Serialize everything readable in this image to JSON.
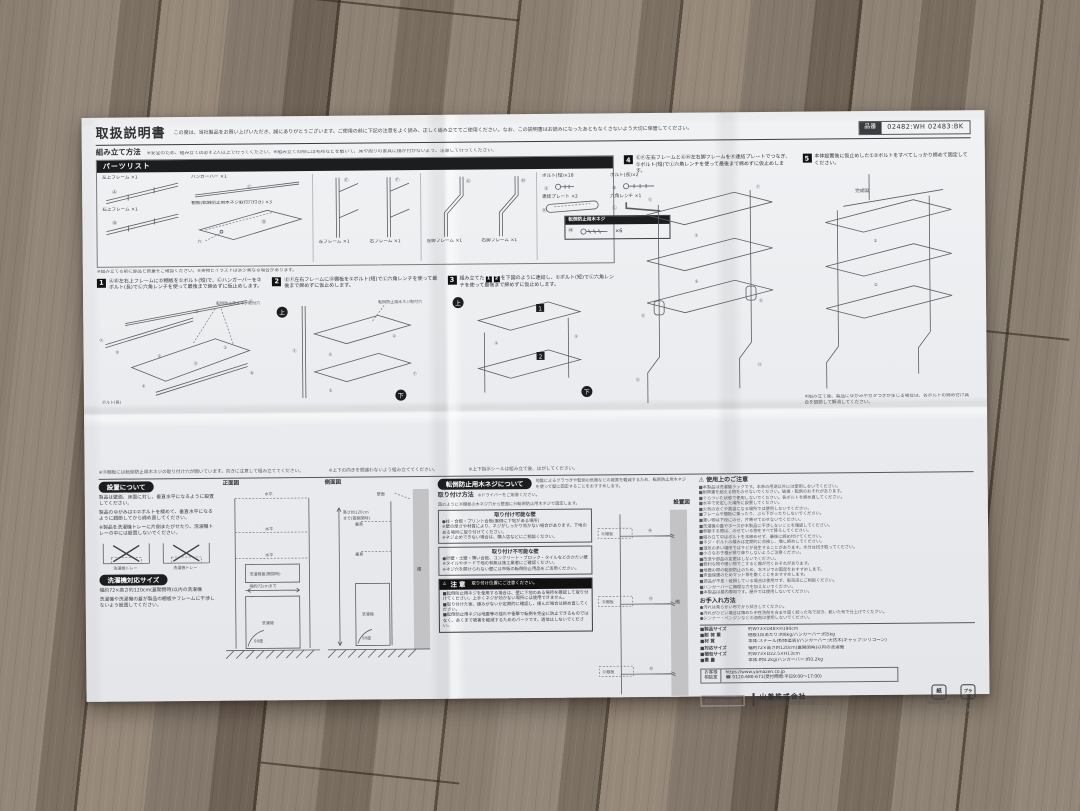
{
  "doc": {
    "title": "取扱説明書",
    "intro": "この度は、当社製品をお買い上げいただき、誠にありがとうございます。ご使用の前に下記の注意をよく読み、正しく組み立ててご使用ください。なお、この説明書はお読みになったあともなくさないよう大切に保管してください。",
    "part_no_label": "品番",
    "part_no": "02482:WH 02483:BK"
  },
  "assembly": {
    "heading": "組み立て方法",
    "note": "※安全のため、組み立ては必ず2人以上で行ってください。※組み立ての際には毛布などを敷いて、床や周りの家具に傷が付かないよう、注意して行ってください。"
  },
  "parts": {
    "heading": "パーツリスト",
    "items": [
      {
        "tag": "Ⓐ",
        "label": "左上フレーム ×1"
      },
      {
        "tag": "Ⓒ",
        "label": "ハンガーバー ×1"
      },
      {
        "tag": "Ⓑ",
        "label": "右上フレーム ×1"
      },
      {
        "tag": "Ⓓ",
        "label": "棚板(転倒防止用木ネジ取付穴付き) ×3"
      },
      {
        "tag": "Ⓔ",
        "label": "左フレーム ×1"
      },
      {
        "tag": "Ⓕ",
        "label": "右フレーム ×1"
      },
      {
        "tag": "Ⓖ",
        "label": "左脚フレーム ×1"
      },
      {
        "tag": "Ⓗ",
        "label": "右脚フレーム ×1"
      },
      {
        "tag": "①",
        "label": "ボルト(短)×18"
      },
      {
        "tag": "②",
        "label": "ボルト(長)×2"
      },
      {
        "tag": "Ⓚ",
        "label": "連結プレート ×2"
      },
      {
        "tag": "Ⓛ",
        "label": "六角レンチ ×1"
      }
    ],
    "wood_screw": {
      "heading": "転倒防止用木ネジ",
      "tag": "Ⓜ",
      "count": "×6"
    },
    "hole_label": "穴",
    "note": "※組み立てる前に部品と数量をご確認ください。※実物とイラストは多少異なる場合があります。"
  },
  "glyphs": {
    "up": "上",
    "down": "下",
    "b1": "①",
    "b2": "②"
  },
  "steps": {
    "s1": {
      "no": "1",
      "text": "ⒶⒷ左右上フレームにⒹ棚板を①ボルト(短)で、Ⓒハンガーバーを②ボルト(長)でⓁ六角レンチを使って最後まで締めずに仮止めします。"
    },
    "s2": {
      "no": "2",
      "text": "ⒺⒻ左右フレームにⒹ棚板を①ボルト(短)でⓁ六角レンチを使って最後まで締めずに仮止めします。"
    },
    "s3": {
      "no": "3",
      "pre": "組み立てた",
      "b1": "1",
      "b2": "2",
      "post": "を下図のように連結し、①ボルト(短)でⓁ六角レンチを使って最後まで締めずに仮止めします。"
    },
    "s4": {
      "no": "4",
      "text": "ⒺⒻ左右フレームとⒼⒽ左右脚フレームをⓀ連結プレートでつなぎ、①ボルト(短)でⓁ六角レンチを使って最後まで締めずに仮止めします。"
    },
    "s5": {
      "no": "5",
      "text": "本体設置後に仮止めした①②ボルトをすべてしっかり締めて固定してください。"
    },
    "labels": {
      "hole": "転倒防止用木ネジ取付穴",
      "bolt_long": "ボルト(長)",
      "complete": "完成図"
    },
    "notes": {
      "shelf": "※Ⓓ棚板には転倒防止用木ネジの取り付け穴が開いています。向きに注意して組み立ててください。",
      "updown": "※上下の向きを間違わないよう組み立ててください。",
      "seal": "※上下指示シールは組み立て後、はがしてください。",
      "wobble": "※組み立て後、製品にゆがみやガタつきが生じる場合は、各ボルトの締め付け具合を調節して解消してください。"
    }
  },
  "setup": {
    "heading": "設置について",
    "p1": "製品は壁面、床面に対し、垂直水平になるように設置してください。",
    "p2": "製品のゆがみは①②ボルトを緩めて、垂直水平になるように調節してから締め直してください。",
    "p3": "※製品を洗濯機トレーに片側またがせたり、洗濯機トレーの中には設置しないでください。",
    "front": "正面図",
    "side": "側面図",
    "labels": {
      "level": "水平",
      "wall_face": "壁面",
      "vertical": "垂直",
      "washer": "洗濯機",
      "lid": "洗濯機蓋(開閉時)",
      "width": "幅約72cmまで",
      "height1": "高さ約120cm",
      "height2": "まで(蓋開閉時)",
      "deg": "90度",
      "wall": "壁",
      "tray": "洗濯機トレー"
    }
  },
  "washer_size": {
    "heading": "洗濯機対応サイズ",
    "p1": "幅約72×高さ約120cm(蓋開閉時)以内の洗濯機",
    "p2": "洗濯機や洗濯機の蓋が製品の棚板やフレームに干渉しないよう設置してください。"
  },
  "anti_tip": {
    "heading": "転倒防止用木ネジについて",
    "intro": "地震によるグラつきや転倒の危険などの被害を軽減するため、転倒防止用木ネジを使って壁に固定することをおすすめします。",
    "method_heading": "取り付け方法",
    "method_note": "※ドライバーをご用意ください。",
    "method_text": "図のようにⒹ棚板の木ネジ穴から壁面にⓂ転倒防止用木ネジで固定します。",
    "diagram_heading": "設置図",
    "shelf_label": "Ⓓ棚板",
    "screw_tag": "Ⓜ",
    "wall": "壁",
    "ok_wall": {
      "heading": "取り付け可能な壁",
      "lines": [
        "●柱・合板・プリント合板(裏側に下地がある場所)",
        "※壁の厚さや材質により、ネジがしっかり効かない場合があります。下地のある場所に取り付けてください。",
        "※ネジ止めできない場合は、購入店などにご相談ください。"
      ]
    },
    "ng_wall": {
      "heading": "取り付け不可能な壁",
      "lines": [
        "●砂壁・土壁・薄い合板、コンクリート・ブロック・タイルなどのかたい壁",
        "※タイルやボード下地の有無は施工業者にご確認ください。",
        "※ネジ穴を開けられない壁には市販の転倒防止用品をご活用ください。"
      ]
    },
    "caution": {
      "mark": "⚠",
      "heading": "注意",
      "sub": "取り付け位置にご注意ください。",
      "lines": [
        "■転倒防止用ネジを使用する場合は、壁に下地のある場所を確認して取り付けてください。上手くネジが効かない場所には使用できません。",
        "■取り付けた後、緩みがないか定期的に確認し、緩んだ場合は締め直してください。",
        "■転倒防止用ネジは地震等の揺れや衝撃で転倒を完全に防止できるものではなく、あくまで被害を軽減するためのパーツです。過信はしないでください。"
      ]
    }
  },
  "precautions": {
    "mark": "⚠",
    "heading": "使用上のご注意",
    "lines": [
      "■本製品は洗濯機ラックです。本来の用途以外には使用しないでください。",
      "■耐荷重を超える物をのせないでください。破損・転倒のおそれがあります。",
      "■ぐらついた状態で使用しないでください。各ボルトを締め直してください。",
      "■水平で安定した場所に設置してください。",
      "■火気の近くや高温になる場所では使用しないでください。",
      "■フレームや棚板に乗ったり、ぶら下がったりしないでください。",
      "■重い物は下段にのせ、片寄せてのせないでください。",
      "■洗濯機の蓋やホースが本製品に干渉しないことを確認してください。",
      "■移動する際は、のせている物をすべて降ろしてください。",
      "■組み立て中はボルトを本締めせず、最後に締め付けてください。",
      "■ネジ・ボルトの緩みは定期的に点検し、増し締めしてください。",
      "■湿気の多い場所ではサビが発生することがあります。水分は拭き取ってください。",
      "■小さなお子様が昇り降りしないようご注意ください。",
      "■改造や部品の変更はしないでください。",
      "■鋭利な物や硬い物でこすると傷が付くおそれがあります。",
      "■地震の際の転倒防止のため、木ネジでの固定をおすすめします。",
      "■床面保護のためマット等を敷くことをおすすめします。",
      "■部品が不足・破損している場合は使用せず、販売店にご相談ください。",
      "■ハンガーバーに無理な力を加えないでください。",
      "■本製品は屋内専用です。屋外では使用しないでください。"
    ]
  },
  "care": {
    "heading": "お手入れ方法",
    "lines": [
      "●汚れは柔らかい布でから拭きしてください。",
      "●汚れがひどい場合は薄めた中性洗剤を含ませ固く絞った布で拭き、乾いた布で仕上げてください。",
      "●シンナー・ベンジンなどの溶剤は使用しないでください。"
    ]
  },
  "specs": {
    "rows": [
      {
        "label": "■製品サイズ",
        "value": "約W73×D48×H190cm"
      },
      {
        "label": "■耐 荷 重",
        "value": "棚板1段あたり:約8kg/ハンガーバー:約5kg"
      },
      {
        "label": "■材   質",
        "value": "本体:スチール(粉体塗装)/ハンガーバー:天然木(キャップ:シリコーン)"
      },
      {
        "label": "■対応サイズ",
        "value": "幅約72×高さ約120cm(蓋開閉時)以内の洗濯機"
      },
      {
        "label": "■梱包サイズ",
        "value": "約W73×D22.5×H13cm"
      },
      {
        "label": "■重   量",
        "value": "本体:約8.2kg/ハンガーバー:約0.2kg"
      }
    ]
  },
  "contact": {
    "l1": "お客様",
    "l2": "相談室",
    "url": "https://www.yamazen.co.jp",
    "tel": "☎ 0120-680-671(受付時間:平日9:00〜17:00)"
  },
  "company": {
    "name": "山善株式会社",
    "addr": "〒550-8660 大阪市西区北堀江1-3-15",
    "code": "取説 02482/02483",
    "marks": [
      {
        "symbol": "紙",
        "caption": "梱包箱・取説"
      },
      {
        "symbol": "プラ",
        "caption": "袋"
      }
    ],
    "footnote": "02482・02483(1804)"
  }
}
